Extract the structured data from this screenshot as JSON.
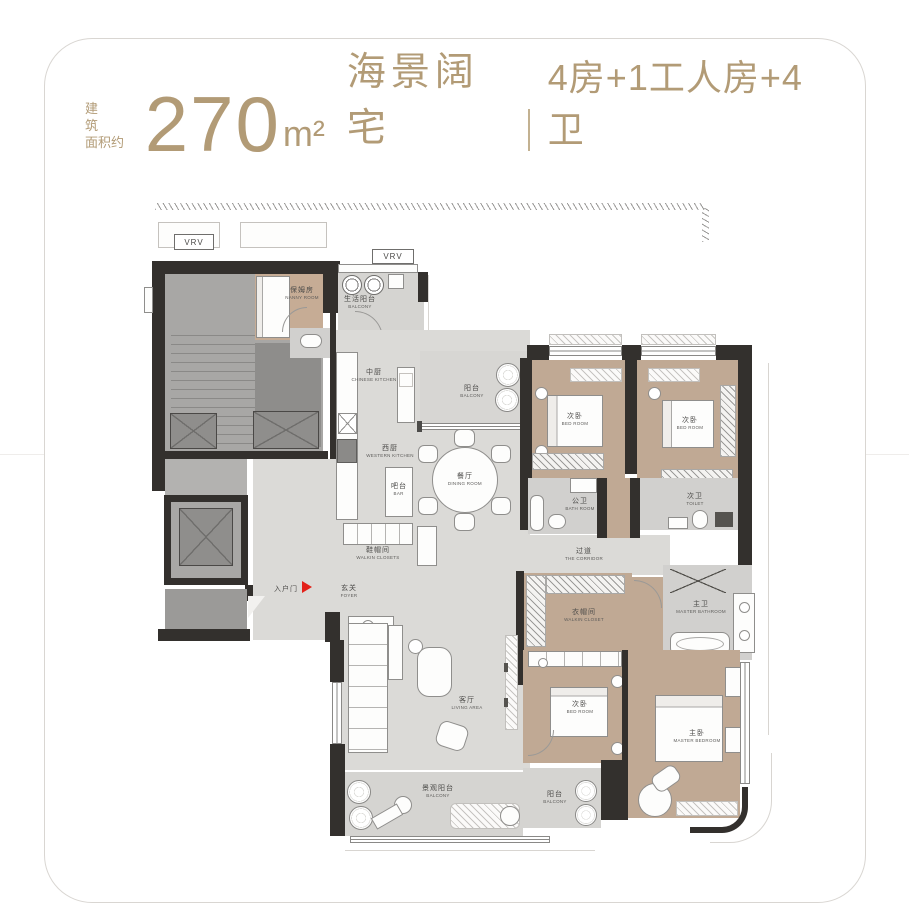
{
  "header": {
    "prefix_line1": "建 筑",
    "prefix_line2": "面积约",
    "area": "270",
    "unit": "m²",
    "title": "海景阔宅",
    "spec": "4房+1工人房+4卫",
    "accent_color": "#b29b76"
  },
  "plan": {
    "vrv1": "VRV",
    "vrv2": "VRV",
    "entry": {
      "zh": "入户门"
    },
    "rooms": {
      "nanny": {
        "zh": "保姆房",
        "en": "NANNY ROOM"
      },
      "service_balcony": {
        "zh": "生活阳台",
        "en": "BALCONY"
      },
      "chinese_kitchen": {
        "zh": "中厨",
        "en": "CHINESE KITCHEN"
      },
      "top_balcony": {
        "zh": "阳台",
        "en": "BALCONY"
      },
      "western_kitchen": {
        "zh": "西厨",
        "en": "WESTERN KITCHEN"
      },
      "bar": {
        "zh": "吧台",
        "en": "BAR"
      },
      "dining": {
        "zh": "餐厅",
        "en": "DINING ROOM"
      },
      "shoe_closet": {
        "zh": "鞋帽间",
        "en": "WALKIN CLOSETS"
      },
      "foyer": {
        "zh": "玄关",
        "en": "FOYER"
      },
      "bedroom_a": {
        "zh": "次卧",
        "en": "BED ROOM"
      },
      "bedroom_b": {
        "zh": "次卧",
        "en": "BED ROOM"
      },
      "public_bath": {
        "zh": "公卫",
        "en": "BATH ROOM"
      },
      "toilet": {
        "zh": "次卫",
        "en": "TOILET"
      },
      "corridor": {
        "zh": "过道",
        "en": "THE CORRIDOR"
      },
      "walkin_closet": {
        "zh": "衣帽间",
        "en": "WALKIN CLOSET"
      },
      "master_bath": {
        "zh": "主卫",
        "en": "MASTER BATHROOM"
      },
      "bedroom_c": {
        "zh": "次卧",
        "en": "BED ROOM"
      },
      "master_bedroom": {
        "zh": "主卧",
        "en": "MASTER BEDROOM"
      },
      "living": {
        "zh": "客厅",
        "en": "LIVING AREA"
      },
      "view_balcony": {
        "zh": "景观阳台",
        "en": "BALCONY"
      },
      "small_balcony": {
        "zh": "阳台",
        "en": "BALCONY"
      }
    },
    "colors": {
      "wall": "#33302d",
      "wood": "#c0a994",
      "marble": "#dbdad7",
      "entry_arrow": "#e32119"
    }
  }
}
